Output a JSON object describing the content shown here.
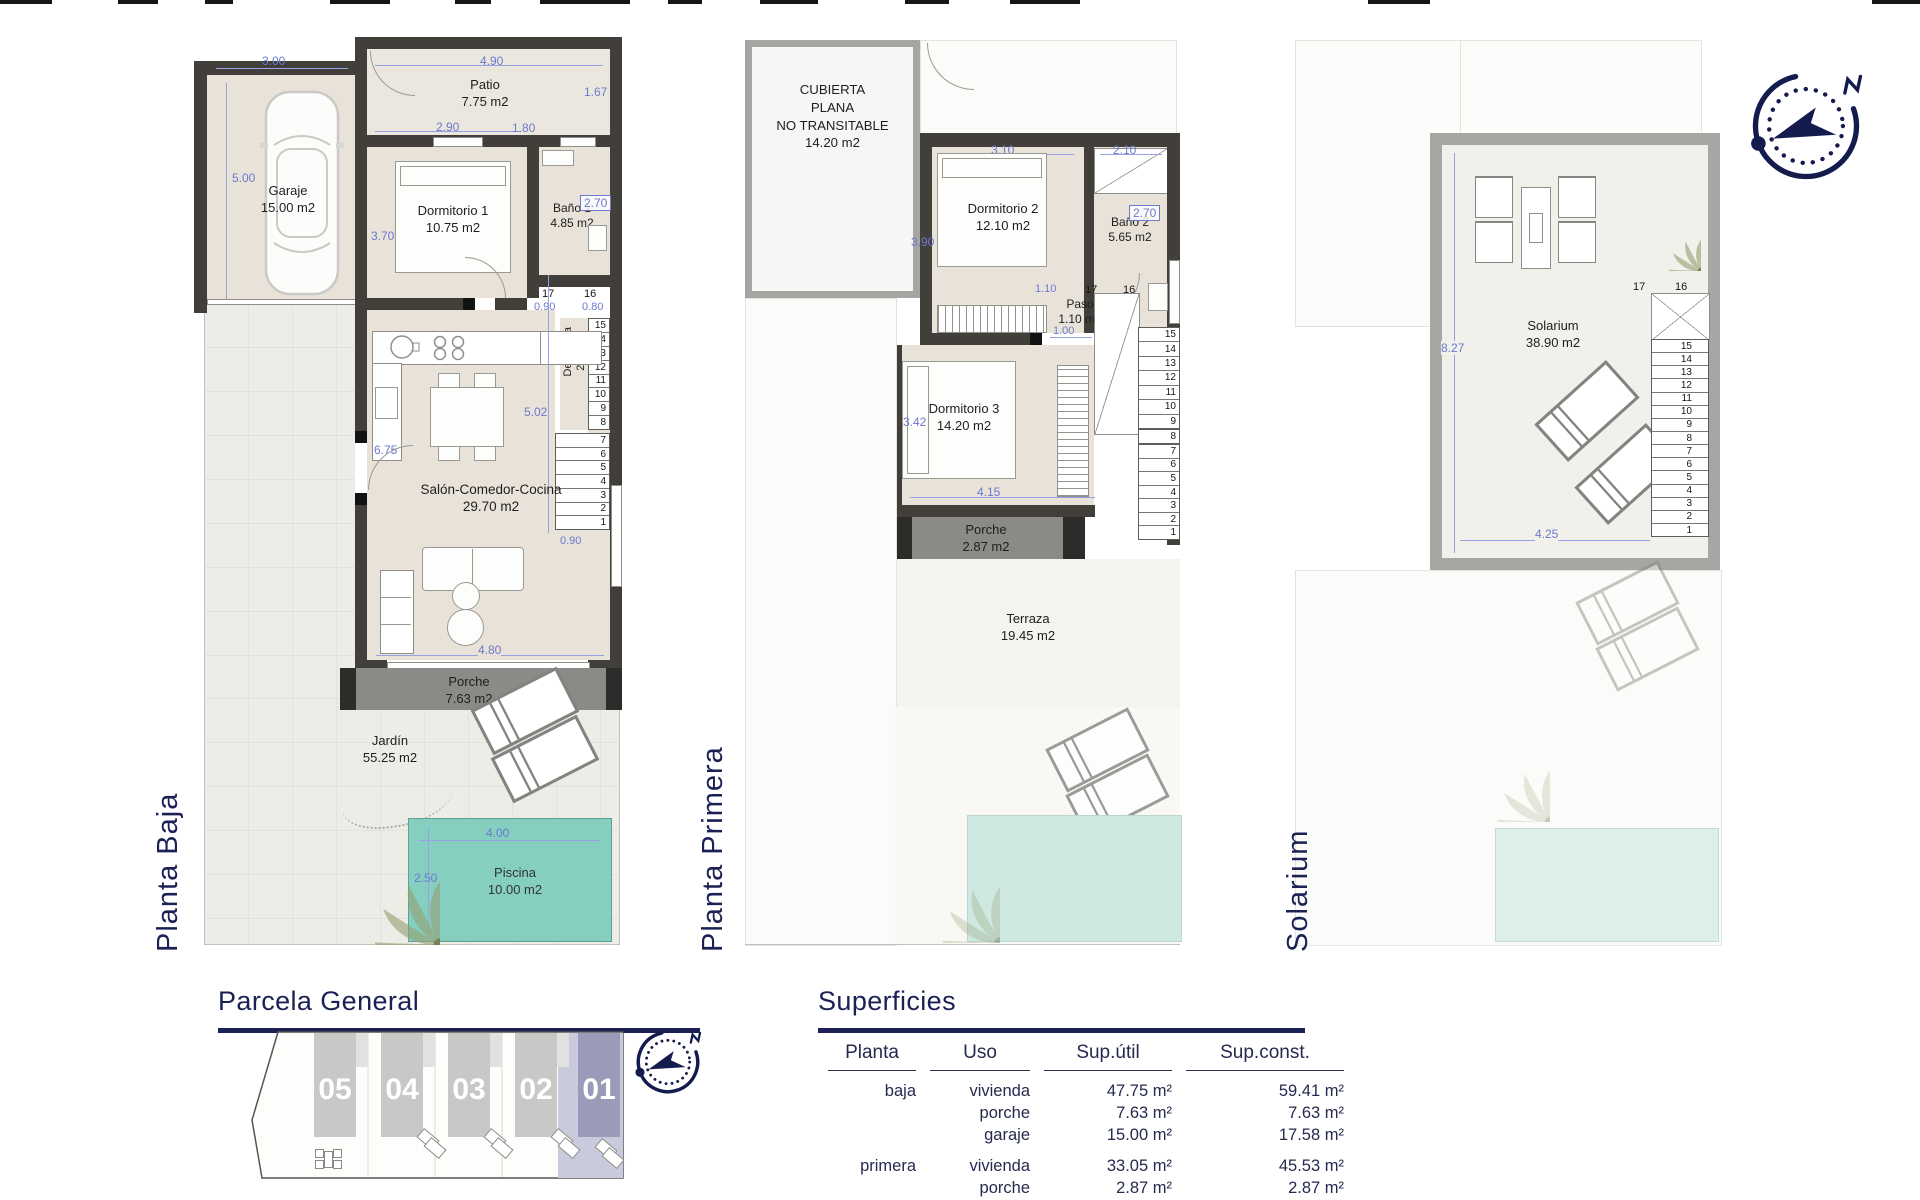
{
  "plans": {
    "baja": {
      "label": "Planta Baja",
      "rooms": {
        "garaje": {
          "name": "Garaje",
          "area": "15.00 m2"
        },
        "patio": {
          "name": "Patio",
          "area": "7.75 m2"
        },
        "dorm1": {
          "name": "Dormitorio 1",
          "area": "10.75 m2"
        },
        "bano1": {
          "name": "Baño 1",
          "area": "4.85 m2"
        },
        "despensa": {
          "name": "Despensa",
          "area": "2.45 m2"
        },
        "salon": {
          "name": "Salón-Comedor-Cocina",
          "area": "29.70 m2"
        },
        "porche": {
          "name": "Porche",
          "area": "7.63 m2"
        },
        "jardin": {
          "name": "Jardín",
          "area": "55.25 m2"
        },
        "piscina": {
          "name": "Piscina",
          "area": "10.00 m2"
        }
      },
      "dims": {
        "w300": "3.00",
        "w500": "5.00",
        "w490": "4.90",
        "w167": "1.67",
        "w290": "2.90",
        "w180": "1.80",
        "w370": "3.70",
        "w270": "2.70",
        "w090a": "0.90",
        "w080": "0.80",
        "w304": "3.04",
        "w502": "5.02",
        "w675": "6.75",
        "w090b": "0.90",
        "w480": "4.80",
        "w400": "4.00",
        "w250": "2.50"
      },
      "stairs": {
        "n17": "17",
        "n16": "16",
        "upper": [
          "15",
          "14",
          "13",
          "12",
          "11",
          "10",
          "9",
          "8"
        ],
        "lower": [
          "7",
          "6",
          "5",
          "4",
          "3",
          "2",
          "1"
        ]
      }
    },
    "primera": {
      "label": "Planta Primera",
      "rooms": {
        "cubierta": {
          "l1": "CUBIERTA",
          "l2": "PLANA",
          "l3": "NO TRANSITABLE",
          "area": "14.20 m2"
        },
        "dorm2": {
          "name": "Dormitorio 2",
          "area": "12.10 m2"
        },
        "bano2": {
          "name": "Baño 2",
          "area": "5.65 m2"
        },
        "paso": {
          "name": "Paso",
          "area": "1.10 m2"
        },
        "dorm3": {
          "name": "Dormitorio 3",
          "area": "14.20 m2"
        },
        "porche": {
          "name": "Porche",
          "area": "2.87 m2"
        },
        "terraza": {
          "name": "Terraza",
          "area": "19.45 m2"
        }
      },
      "dims": {
        "w310": "3.10",
        "w210": "2.10",
        "w390": "3.90",
        "w270": "2.70",
        "w110": "1.10",
        "w100": "1.00",
        "w342": "3.42",
        "w415": "4.15"
      },
      "stairs": {
        "n17": "17",
        "n16": "16",
        "upper": [
          "15",
          "14",
          "13",
          "12",
          "11",
          "10",
          "9"
        ],
        "mid": "8",
        "lower": [
          "7",
          "6",
          "5",
          "4",
          "3",
          "2",
          "1"
        ]
      }
    },
    "solarium": {
      "label": "Solarium",
      "rooms": {
        "solarium": {
          "name": "Solarium",
          "area": "38.90 m2"
        }
      },
      "dims": {
        "w827": "8.27",
        "w425": "4.25"
      },
      "stairs": {
        "n17": "17",
        "n16": "16",
        "column": [
          "15",
          "14",
          "13",
          "12",
          "11",
          "10",
          "9",
          "8",
          "7",
          "6",
          "5",
          "4",
          "3",
          "2",
          "1"
        ]
      }
    }
  },
  "parcela": {
    "title": "Parcela General",
    "units": [
      "05",
      "04",
      "03",
      "02",
      "01"
    ],
    "highlight_unit": "01",
    "highlight_color": "#9b9bb9"
  },
  "superficies": {
    "title": "Superficies",
    "headers": {
      "planta": "Planta",
      "uso": "Uso",
      "util": "Sup.útil",
      "const": "Sup.const."
    },
    "rows": [
      {
        "planta": "baja",
        "uso": "vivienda",
        "util": "47.75 m²",
        "const": "59.41 m²"
      },
      {
        "planta": "",
        "uso": "porche",
        "util": "7.63 m²",
        "const": "7.63 m²"
      },
      {
        "planta": "",
        "uso": "garaje",
        "util": "15.00 m²",
        "const": "17.58 m²"
      },
      {
        "planta": "primera",
        "uso": "vivienda",
        "util": "33.05 m²",
        "const": "45.53 m²"
      },
      {
        "planta": "",
        "uso": "porche",
        "util": "2.87 m²",
        "const": "2.87 m²"
      }
    ],
    "total": {
      "label": "Total",
      "util": "106.30 m²",
      "const": "133.02 m²"
    }
  },
  "colors": {
    "navy": "#1b2154",
    "dim_blue": "#6b7ace",
    "pool": "#84cfc0",
    "wall": "#423f3b"
  }
}
